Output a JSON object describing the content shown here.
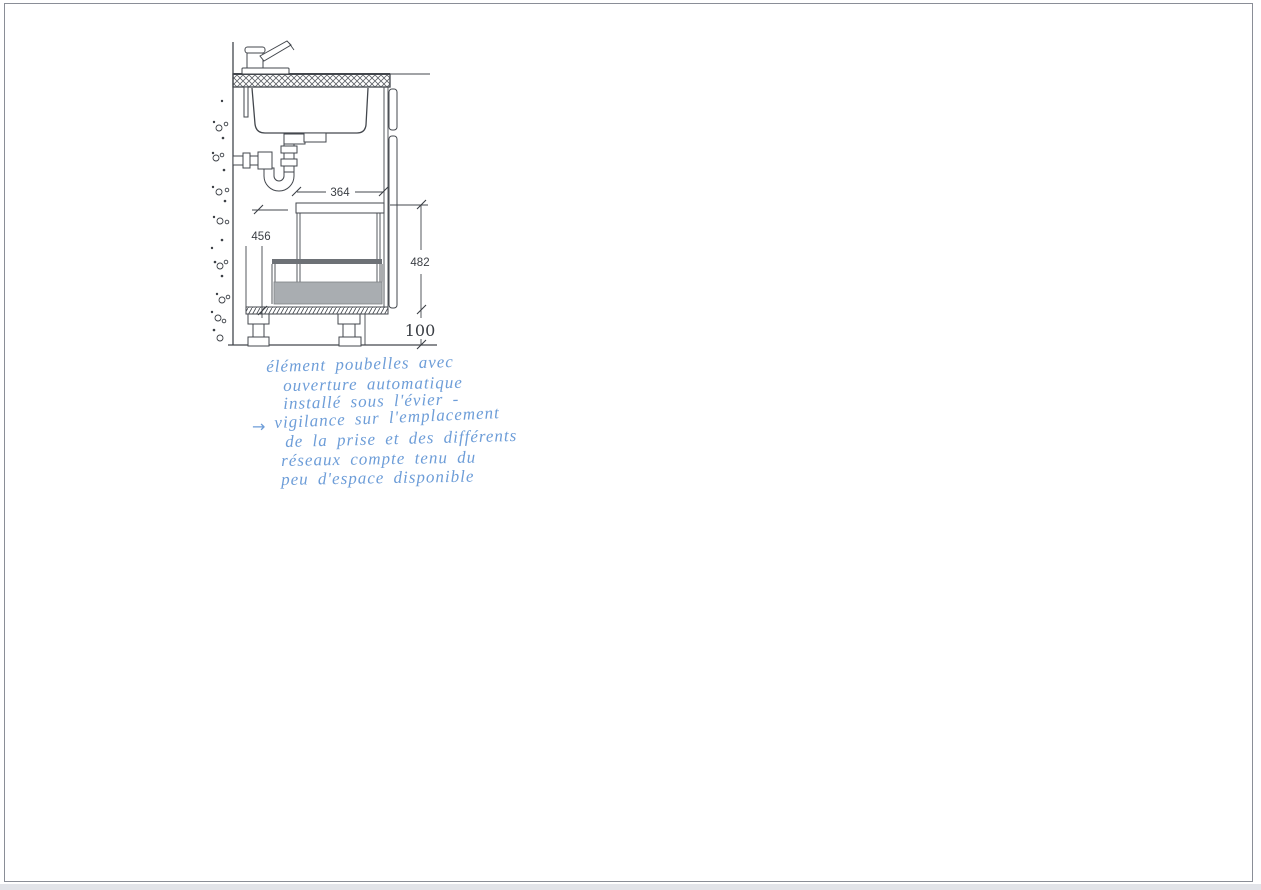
{
  "page": {
    "background": "#ffffff",
    "frame_border_color": "#8a8e97",
    "bottom_strip_color": "#e2e4e9"
  },
  "drawing": {
    "line_color": "#43474d",
    "bin_fill_color": "#a9adb1",
    "bin_rail_color": "#6d7176",
    "dimensions": {
      "bin_width_mm": "364",
      "left_height_mm": "456",
      "front_height_mm": "482",
      "plinth_height_mm": "100"
    }
  },
  "handwriting": {
    "ink_color": "#6d9dd8",
    "arrow_glyph": "→",
    "lines": [
      "élément poubelles avec",
      "ouverture automatique",
      "installé sous l'évier -",
      "vigilance sur l'emplacement",
      "de la prise et des différents",
      "réseaux compte tenu du",
      "peu d'espace disponible"
    ]
  }
}
